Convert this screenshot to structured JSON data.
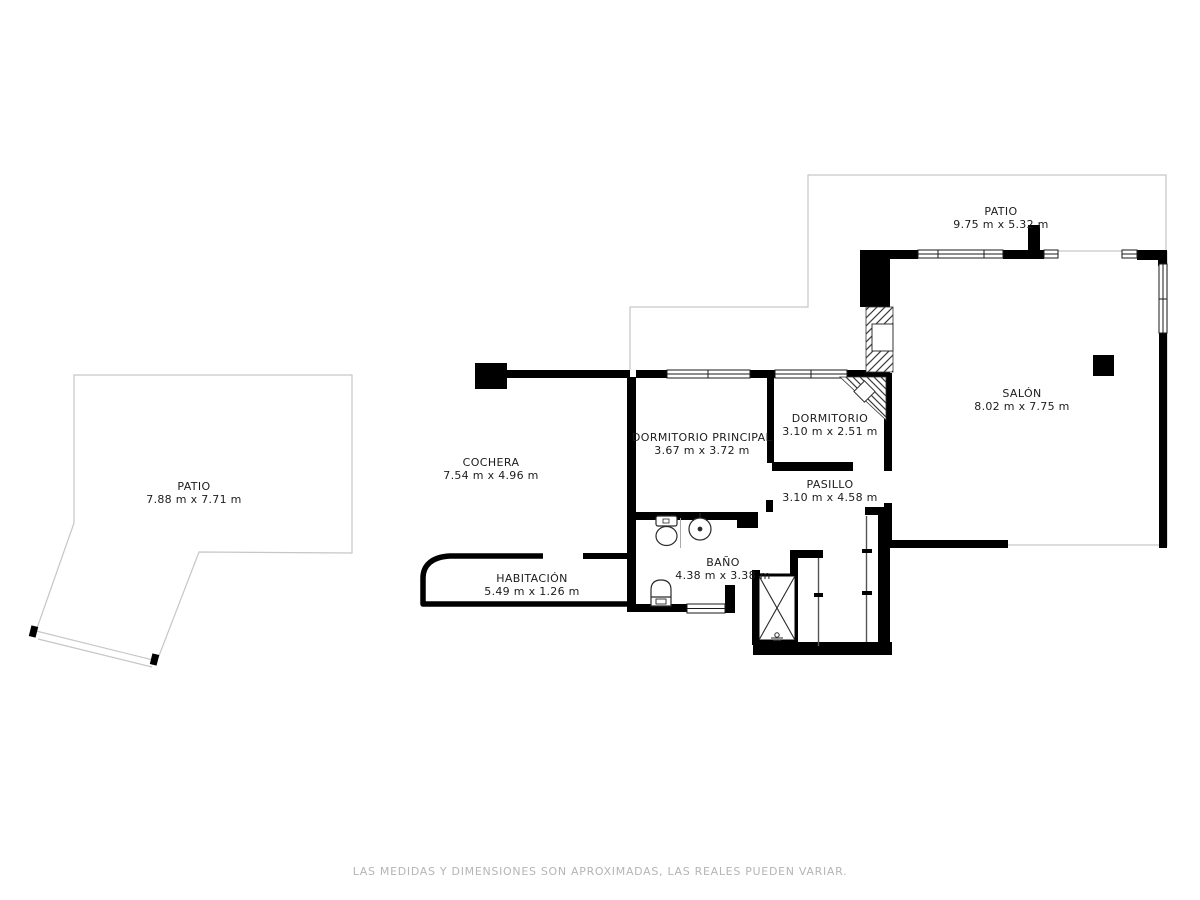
{
  "plan": {
    "rooms": [
      {
        "id": "patio-izquierdo",
        "label": "PATIO",
        "dims": "7.88 m x 7.71 m"
      },
      {
        "id": "patio-superior",
        "label": "PATIO",
        "dims": "9.75 m x 5.32 m"
      },
      {
        "id": "cochera",
        "label": "COCHERA",
        "dims": "7.54 m x 4.96 m"
      },
      {
        "id": "dormitorio-principal",
        "label": "DORMITORIO PRINCIPAL",
        "dims": "3.67 m x 3.72 m"
      },
      {
        "id": "dormitorio",
        "label": "DORMITORIO",
        "dims": "3.10 m x 2.51 m"
      },
      {
        "id": "pasillo",
        "label": "PASILLO",
        "dims": "3.10 m x 4.58 m"
      },
      {
        "id": "salon",
        "label": "SALÓN",
        "dims": "8.02 m x 7.75 m"
      },
      {
        "id": "bano",
        "label": "BAÑO",
        "dims": "4.38 m x 3.38 m"
      },
      {
        "id": "habitacion",
        "label": "HABITACIÓN",
        "dims": "5.49 m x 1.26 m"
      }
    ],
    "footer": {
      "disclaimer": "LAS MEDIDAS Y DIMENSIONES SON APROXIMADAS, LAS REALES PUEDEN VARIAR."
    },
    "colors": {
      "wall": "#000000",
      "outline": "#c6c6c6",
      "label_text": "#1c1c1c",
      "disclaimer_text": "#b5b5b5"
    }
  }
}
